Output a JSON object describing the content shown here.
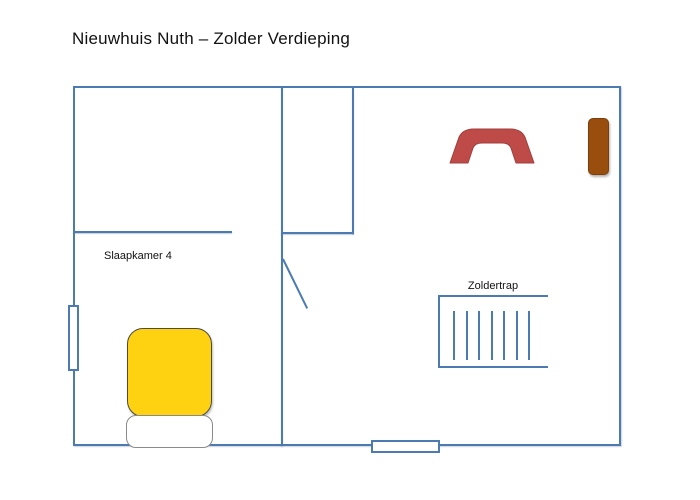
{
  "title": "Nieuwhuis Nuth – Zolder Verdieping",
  "floorplan": {
    "bedroom": {
      "label": "Slaapkamer 4"
    },
    "stairs": {
      "label": "Zoldertrap",
      "tread_count": 7
    },
    "colors": {
      "wall": "#4b7bb0",
      "bed": "#FFD211",
      "arch": "#BE4B48",
      "wood_door": "#9A4E0E"
    }
  }
}
